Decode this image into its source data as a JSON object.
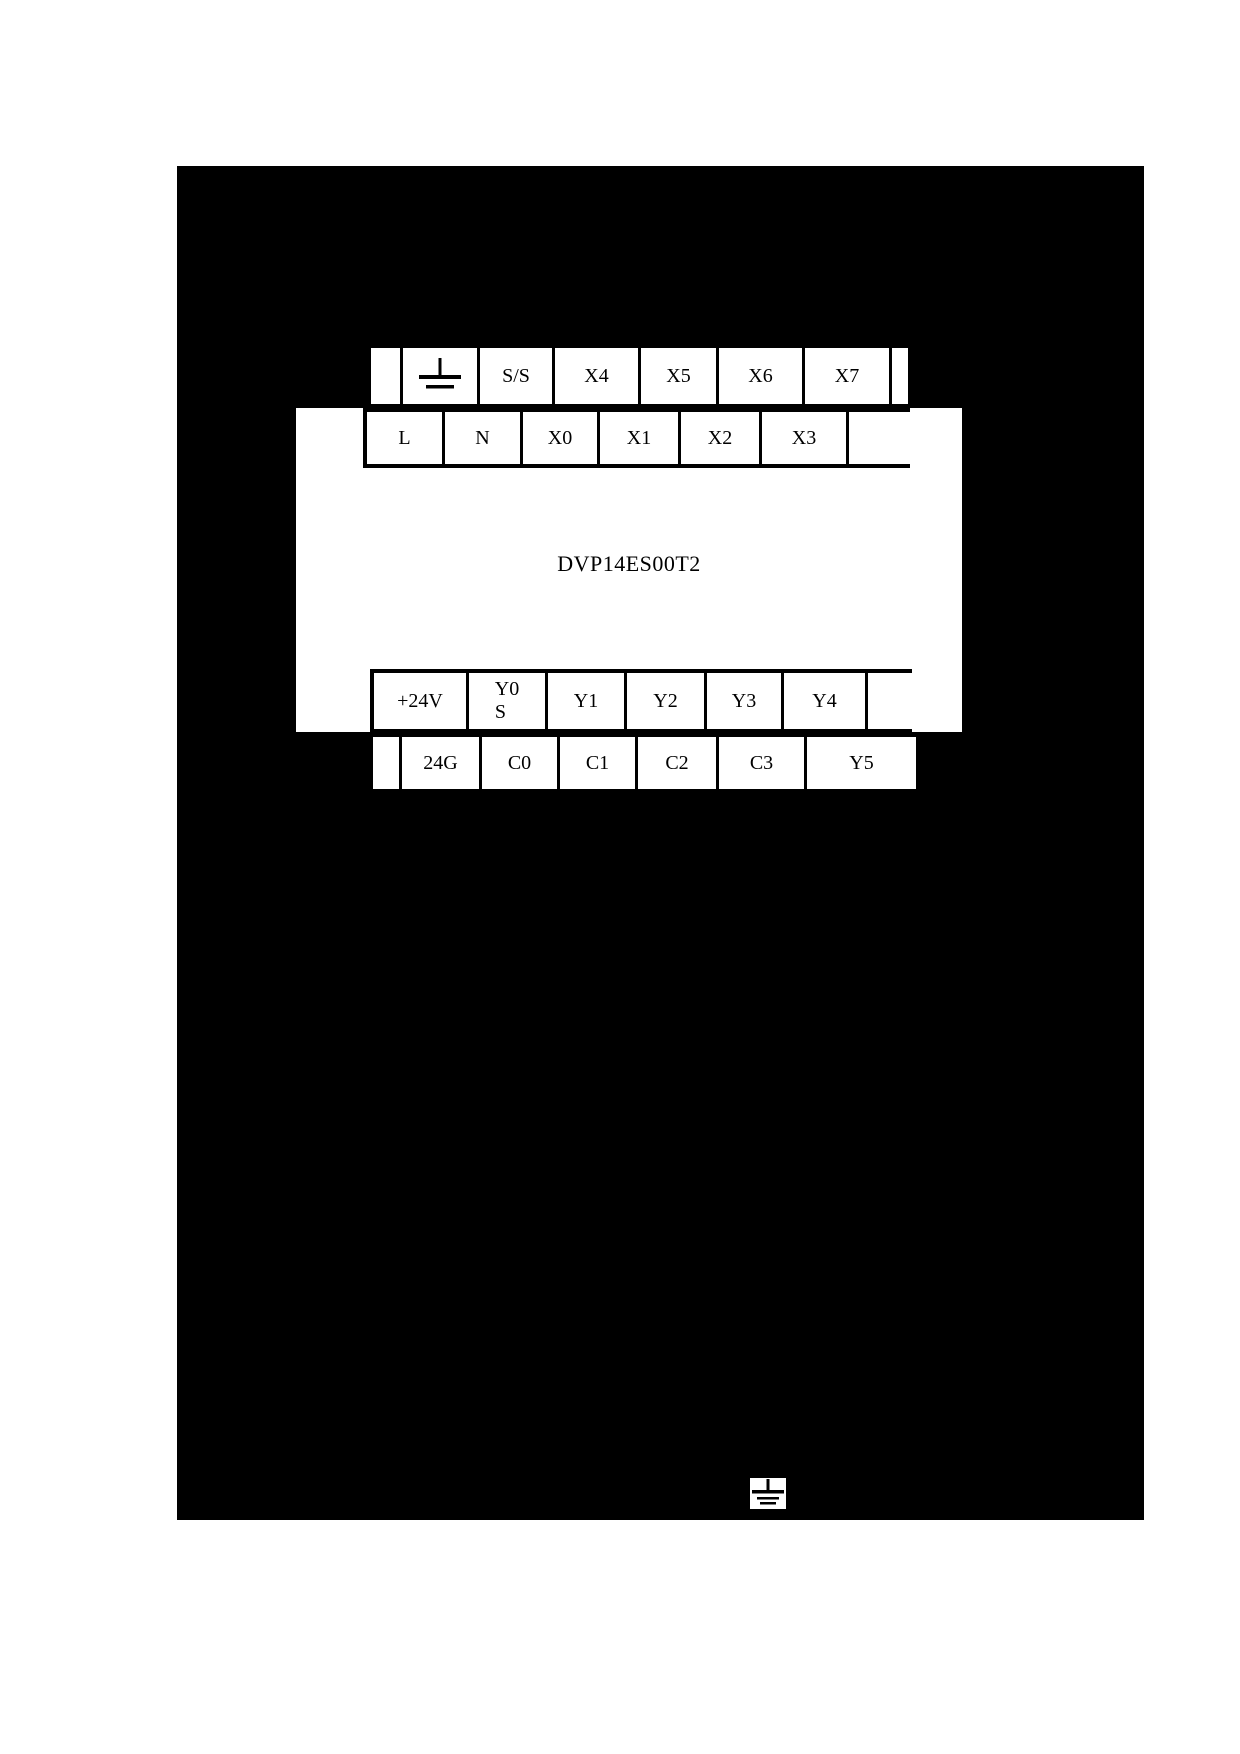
{
  "device": {
    "model": "DVP14ES00T2"
  },
  "terminal_rows": {
    "top_outer": {
      "cells": [
        "",
        "",
        "S/S",
        "X4",
        "X5",
        "X6",
        "X7",
        ""
      ]
    },
    "top_inner": {
      "cells": [
        "L",
        "N",
        "X0",
        "X1",
        "X2",
        "X3",
        ""
      ]
    },
    "bottom_inner": {
      "cells": [
        "+24V",
        "Y0",
        "Y1",
        "Y2",
        "Y3",
        "Y4",
        ""
      ],
      "sub_label": "S"
    },
    "bottom_outer": {
      "cells": [
        "",
        "24G",
        "C0",
        "C1",
        "C2",
        "C3",
        "Y5"
      ]
    }
  },
  "icons": {
    "row_ground": "earth-ground-symbol",
    "corner_ground": "earth-ground-symbol"
  },
  "colors": {
    "background": "#000000",
    "panel": "#ffffff",
    "line": "#000000",
    "text": "#000000"
  }
}
